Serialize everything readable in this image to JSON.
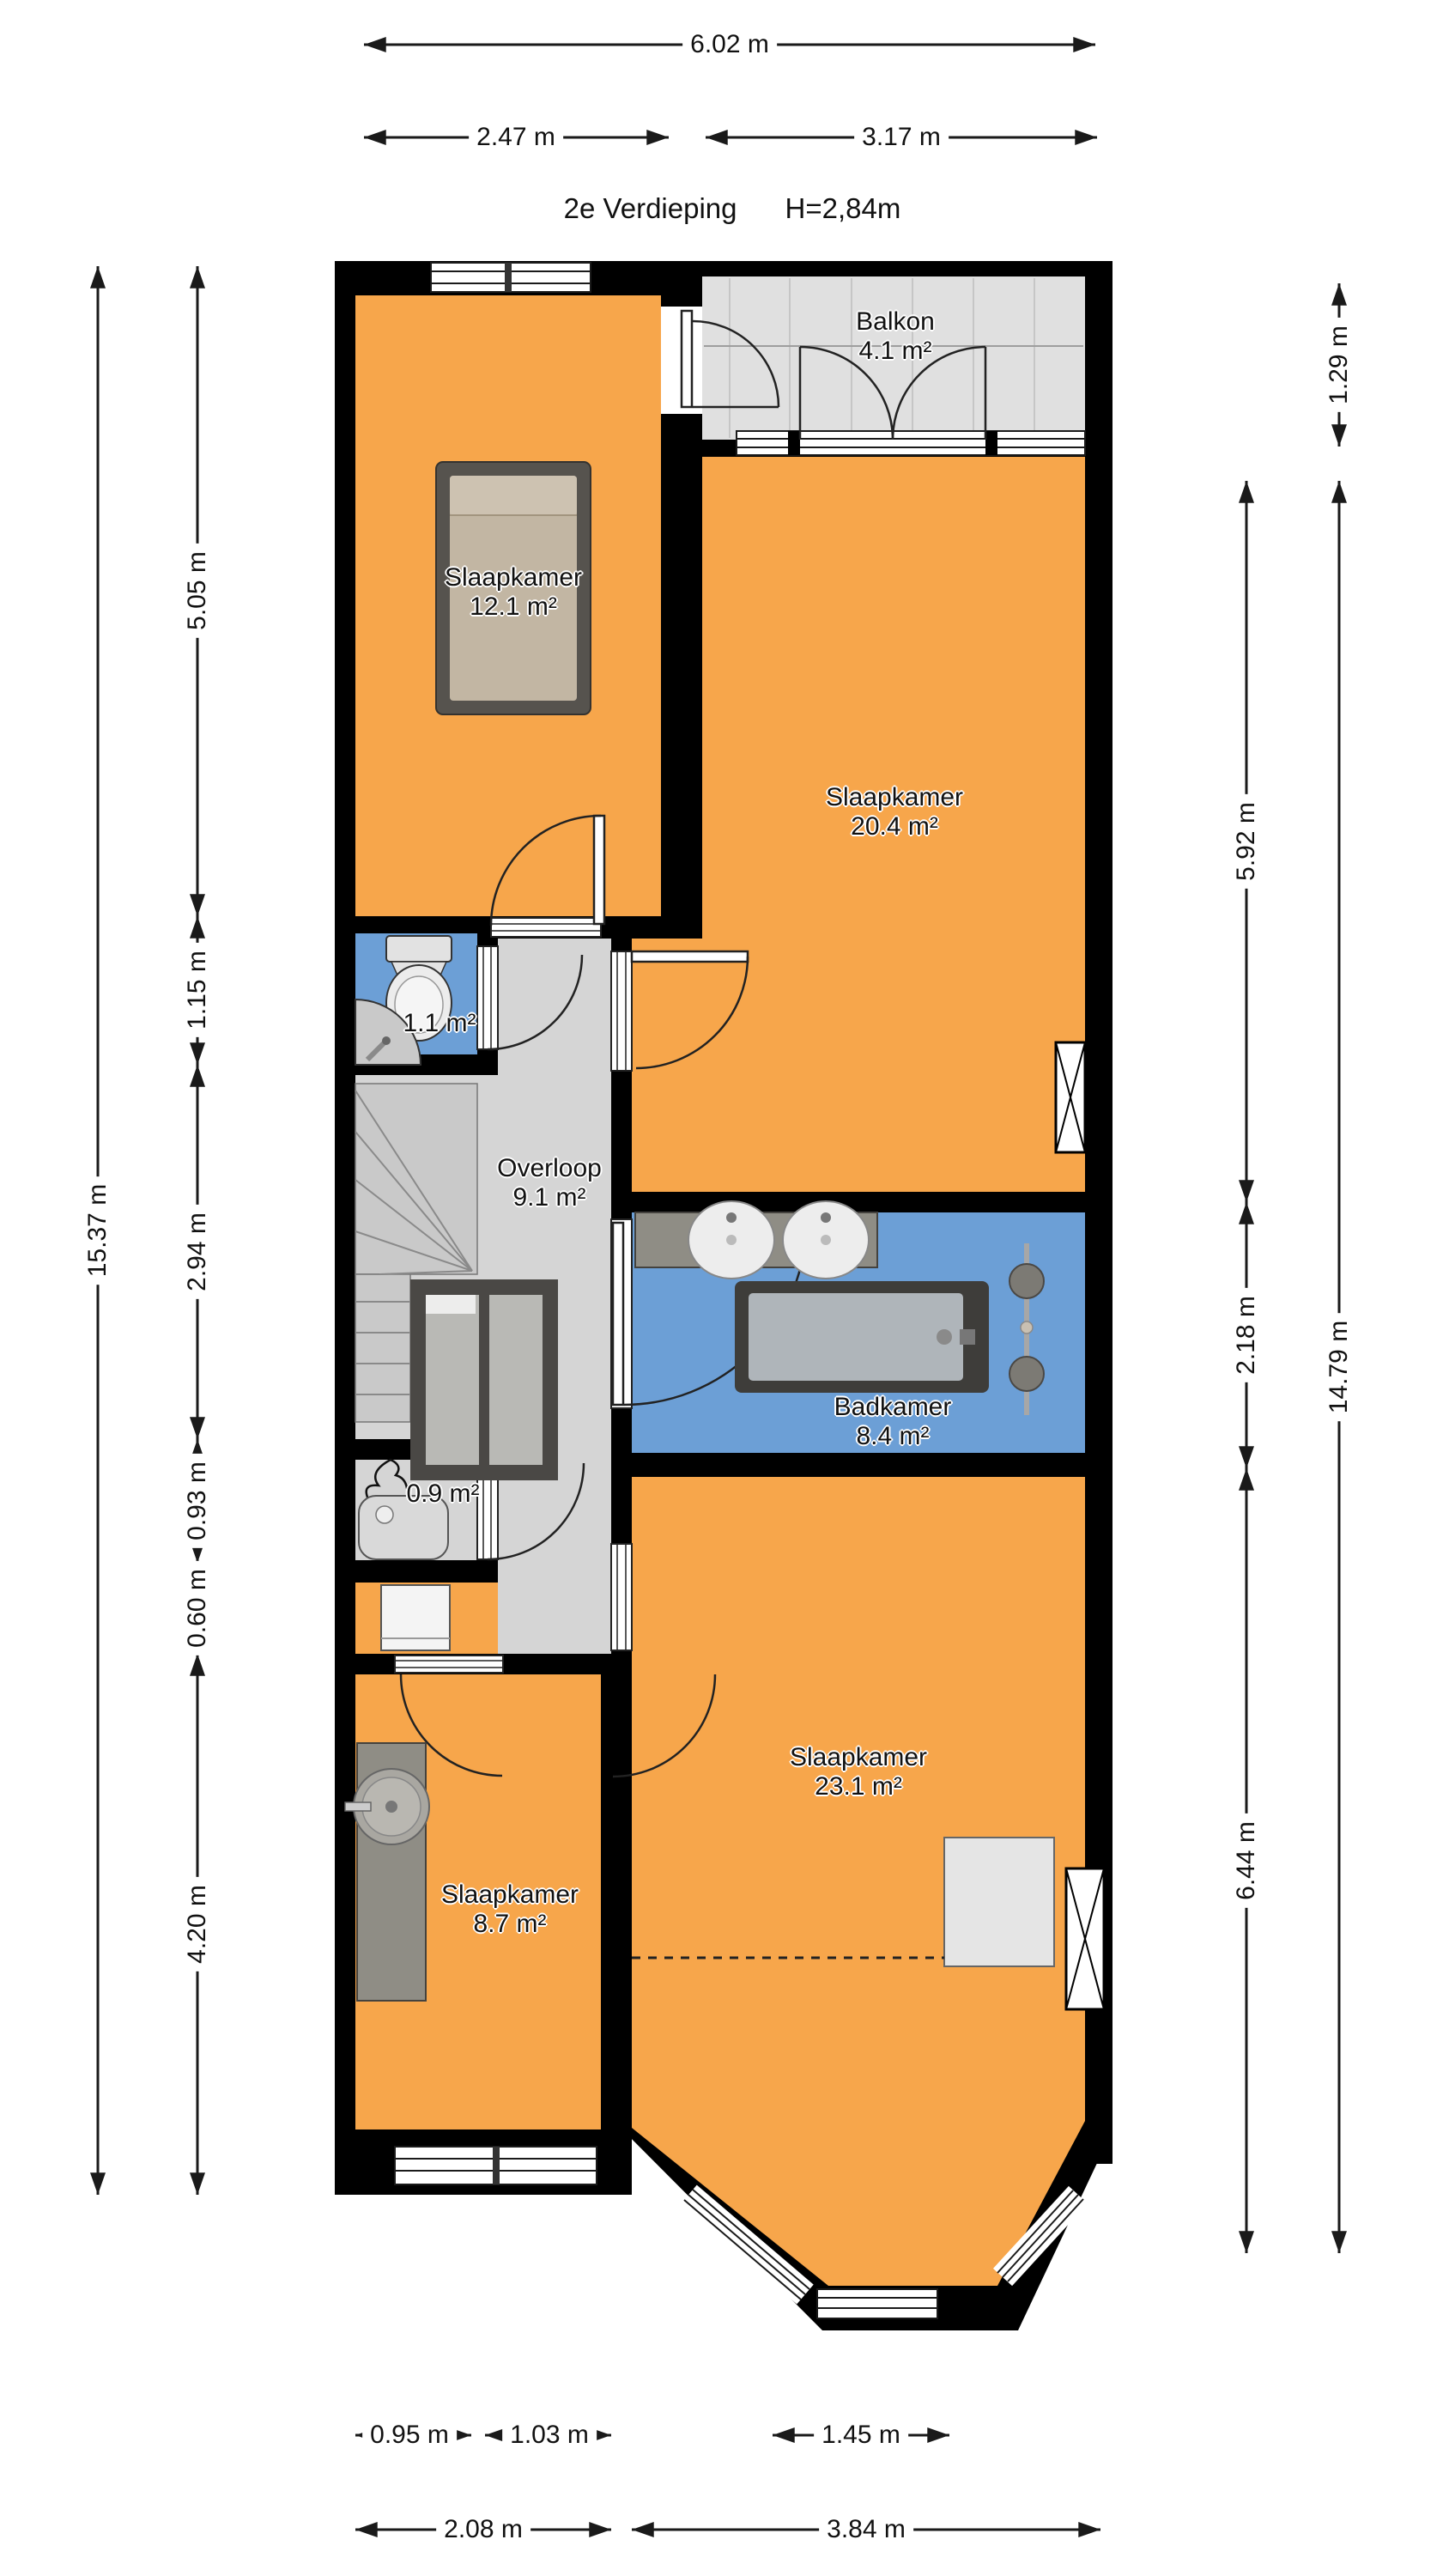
{
  "title": {
    "floor": "2e Verdieping",
    "ceiling_height": "H=2,84m"
  },
  "rooms": {
    "balkon": {
      "name": "Balkon",
      "area": "4.1 m²"
    },
    "slaapkamer_voor": {
      "name": "Slaapkamer",
      "area": "12.1 m²"
    },
    "slaapkamer_midden": {
      "name": "Slaapkamer",
      "area": "20.4 m²"
    },
    "toilet": {
      "area": "1.1 m²"
    },
    "overloop": {
      "name": "Overloop",
      "area": "9.1 m²"
    },
    "badkamer": {
      "name": "Badkamer",
      "area": "8.4 m²"
    },
    "cv_kast": {
      "area": "0.9 m²"
    },
    "slaapkamer_achter": {
      "name": "Slaapkamer",
      "area": "23.1 m²"
    },
    "slaapkamer_klein": {
      "name": "Slaapkamer",
      "area": "8.7 m²"
    }
  },
  "dimensions": {
    "top": {
      "total": "6.02 m",
      "left": "2.47 m",
      "right": "3.17 m"
    },
    "left": {
      "total": "15.37 m",
      "segments": [
        "5.05 m",
        "1.15 m",
        "2.94 m",
        "0.93 m",
        "0.60 m",
        "4.20 m"
      ]
    },
    "right": {
      "total": "14.79 m",
      "balkon": "1.29 m",
      "segments": [
        "5.92 m",
        "2.18 m",
        "6.44 m"
      ]
    },
    "bottom": {
      "row1": [
        "0.95 m",
        "1.03 m",
        "1.45 m"
      ],
      "row2": [
        "2.08 m",
        "3.84 m"
      ]
    }
  },
  "colors": {
    "wall": "#000000",
    "room-orange": "#F7A64B",
    "room-blue": "#6C9FD6",
    "room-gray": "#D5D5D5",
    "stair-gray": "#C9C9C9",
    "balkon-gray": "#E0E0E0",
    "line-dark": "#1A1A1A",
    "furn-dark": "#56534E",
    "mattress": "#C2B6A3",
    "counter": "#8F8D85"
  }
}
